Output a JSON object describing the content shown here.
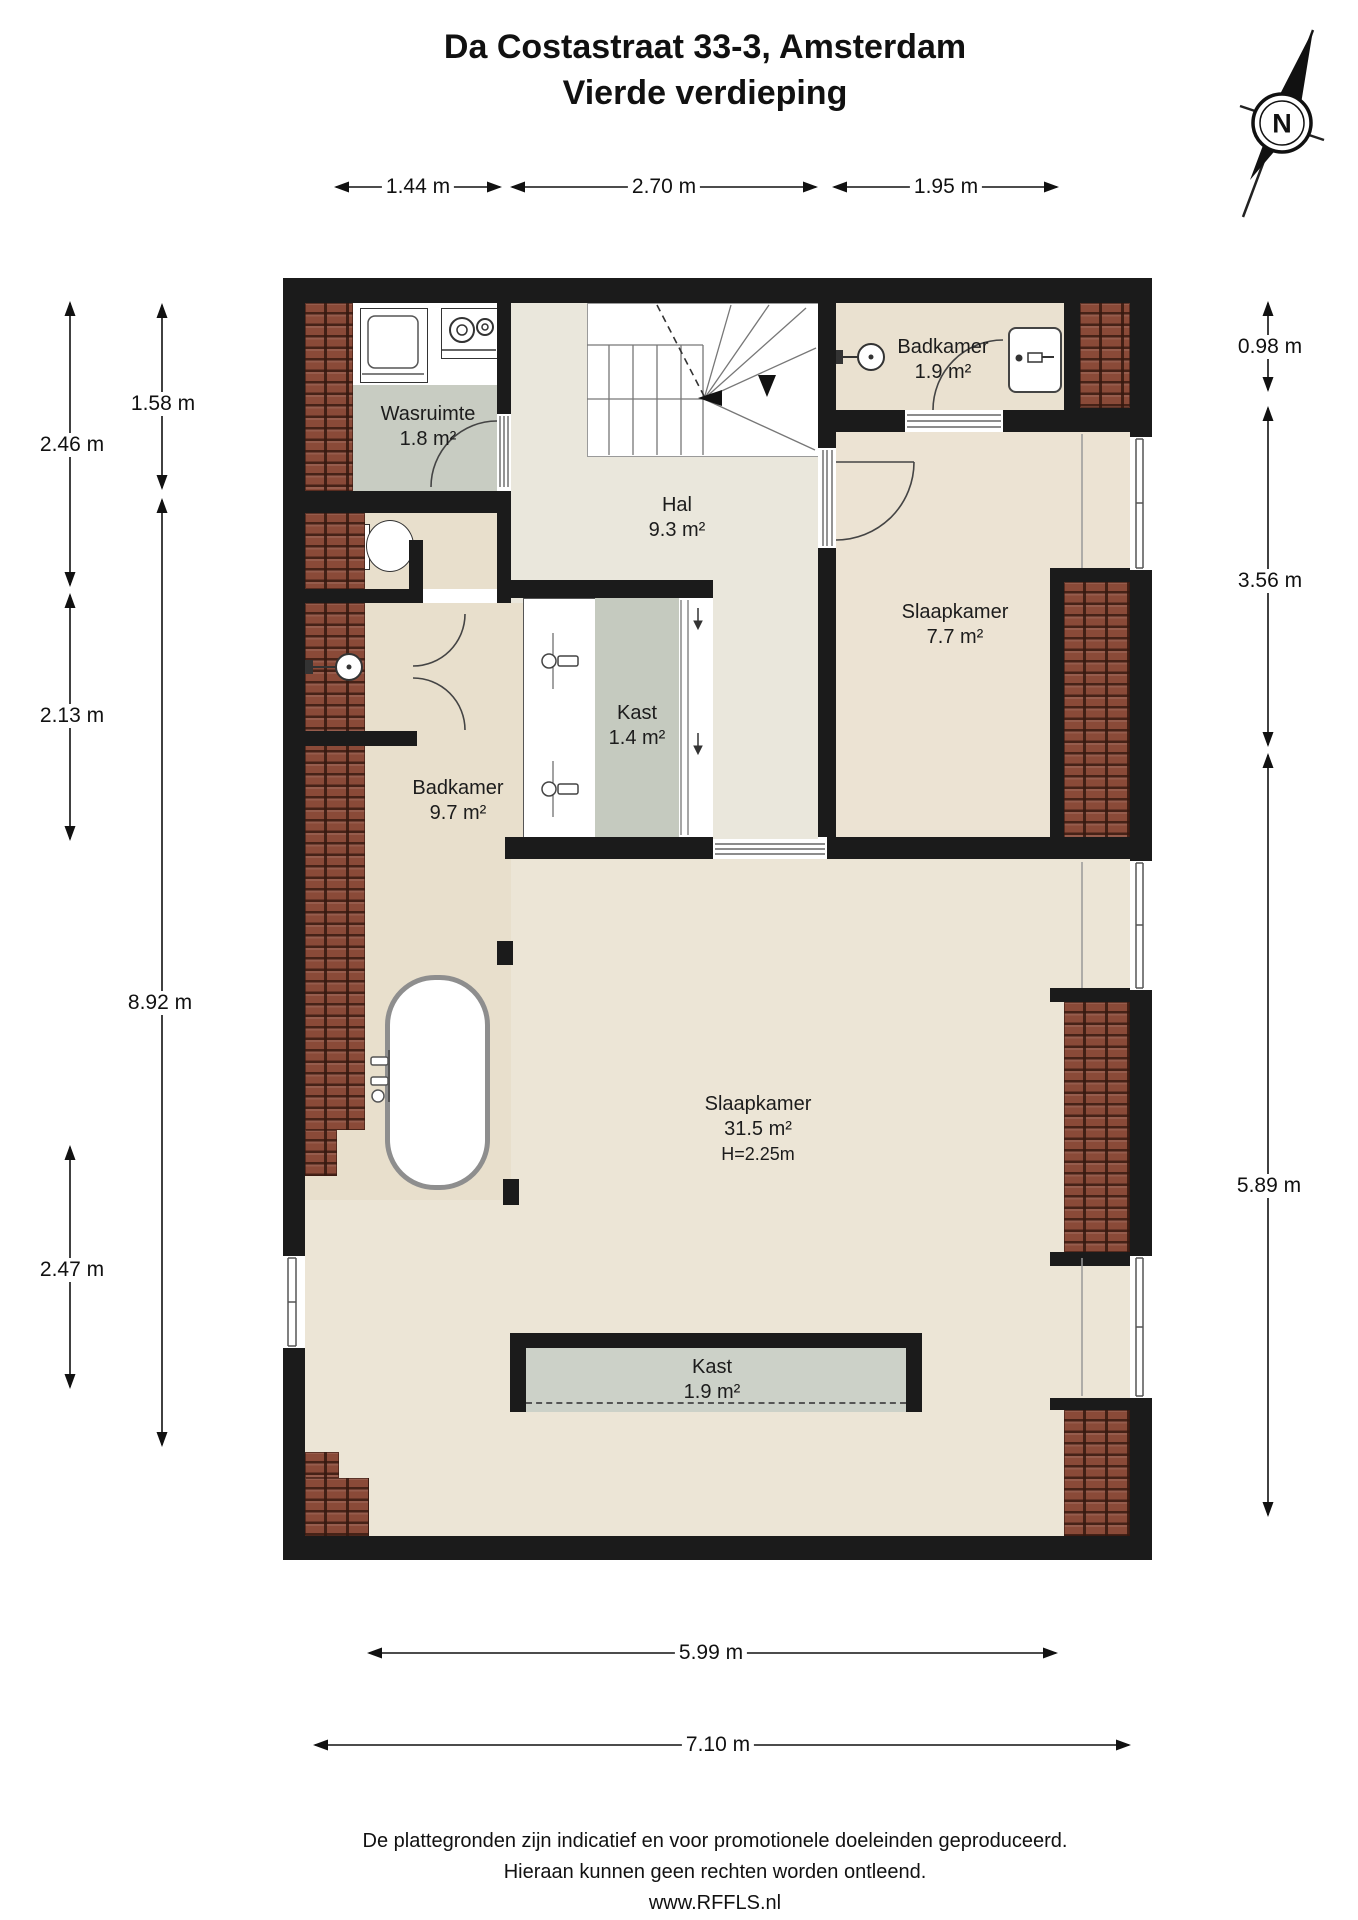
{
  "title": {
    "line1": "Da Costastraat 33-3, Amsterdam",
    "line2": "Vierde verdieping"
  },
  "compass": {
    "label": "N"
  },
  "rooms": {
    "wasruimte": {
      "name": "Wasruimte",
      "area": "1.8 m²"
    },
    "hal": {
      "name": "Hal",
      "area": "9.3 m²"
    },
    "badkamer_klein": {
      "name": "Badkamer",
      "area": "1.9 m²"
    },
    "slaapkamer_klein": {
      "name": "Slaapkamer",
      "area": "7.7 m²"
    },
    "kast_klein": {
      "name": "Kast",
      "area": "1.4 m²"
    },
    "badkamer_groot": {
      "name": "Badkamer",
      "area": "9.7 m²"
    },
    "slaapkamer_groot": {
      "name": "Slaapkamer",
      "area": "31.5 m²",
      "height": "H=2.25m"
    },
    "kast_groot": {
      "name": "Kast",
      "area": "1.9 m²"
    }
  },
  "dimensions": {
    "top": [
      "1.44 m",
      "2.70 m",
      "1.95 m"
    ],
    "left_outer": [
      "2.46 m",
      "2.13 m",
      "2.47 m"
    ],
    "left_inner": [
      "1.58 m",
      "8.92 m"
    ],
    "right": [
      "0.98 m",
      "3.56 m",
      "5.89 m"
    ],
    "bottom": [
      "5.99 m",
      "7.10 m"
    ]
  },
  "footer": {
    "line1": "De plattegronden zijn indicatief en voor promotionele doeleinden geproduceerd.",
    "line2": "Hieraan kunnen geen rechten worden ontleend.",
    "line3": "www.RFFLS.nl"
  },
  "colors": {
    "wall": "#1b1b1b",
    "floor": "#ece5d6",
    "floor_hal": "#eae7dc",
    "floor_warm": "#eae1d0",
    "floor_s77": "#ece3d3",
    "floor_bath": "#e8dfcc",
    "gray_floor": "#c8ccc2",
    "kast_gray": "#c5cabf",
    "kast19_gray": "#ccd1c8",
    "brick": "#8a4a38",
    "line": "#111111"
  }
}
